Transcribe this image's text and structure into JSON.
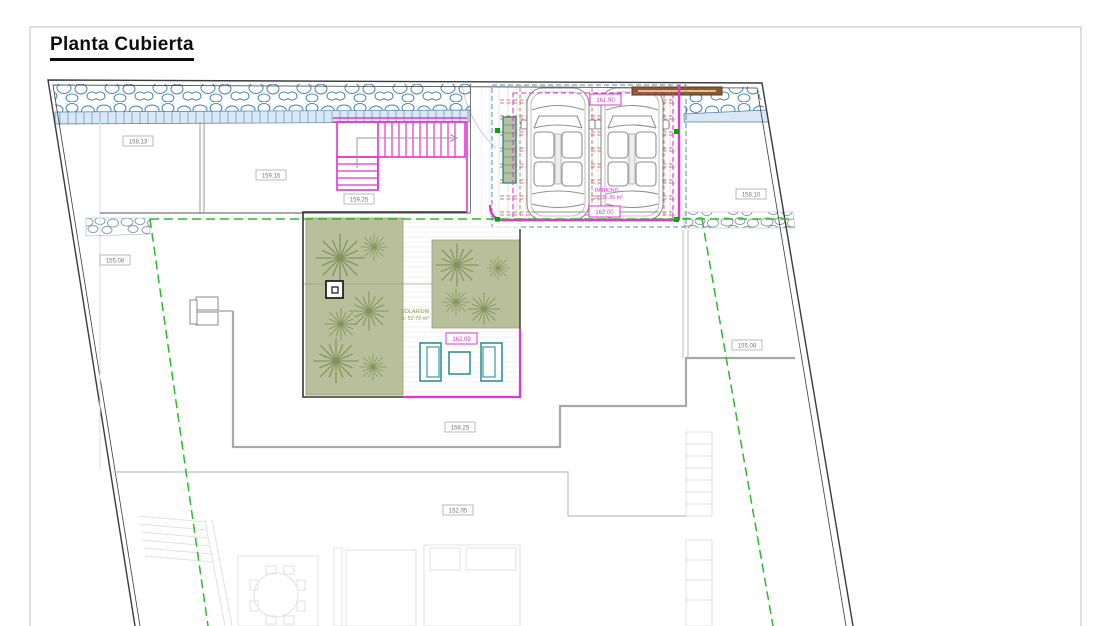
{
  "page": {
    "title": "Planta Cubierta"
  },
  "plan": {
    "level_tags": [
      {
        "id": "level-158-13",
        "text": "158.13"
      },
      {
        "id": "level-159-15",
        "text": "159.15"
      },
      {
        "id": "level-159-25",
        "text": "159.25"
      },
      {
        "id": "level-158-10",
        "text": "158.10"
      },
      {
        "id": "level-155-08-left",
        "text": "155.08"
      },
      {
        "id": "level-155-08-right",
        "text": "155.08"
      },
      {
        "id": "level-158-25",
        "text": "158.25"
      },
      {
        "id": "level-152-05",
        "text": "152.05"
      }
    ],
    "spot_levels": [
      {
        "id": "parking-level-top",
        "text": "161.90"
      },
      {
        "id": "parking-level-bottom",
        "text": "162.00"
      },
      {
        "id": "solarium-level",
        "text": "162.09"
      }
    ],
    "areas": {
      "parking": {
        "label": "PARKING",
        "surface": "S: 36.35 m²"
      },
      "solarium": {
        "label": "SOLARIUM",
        "surface": "S: 52.70 m²"
      }
    },
    "colors": {
      "magenta": "#e433d7",
      "stone_blue": "#4a82b0",
      "setback_green": "#2eb82e",
      "marker_green": "#0aa00a",
      "pergola_red": "#c0504d",
      "vegetation_fill": "#b9bf9b",
      "furniture_teal": "#17808f",
      "gate_brown": "#8a5a2b"
    }
  }
}
